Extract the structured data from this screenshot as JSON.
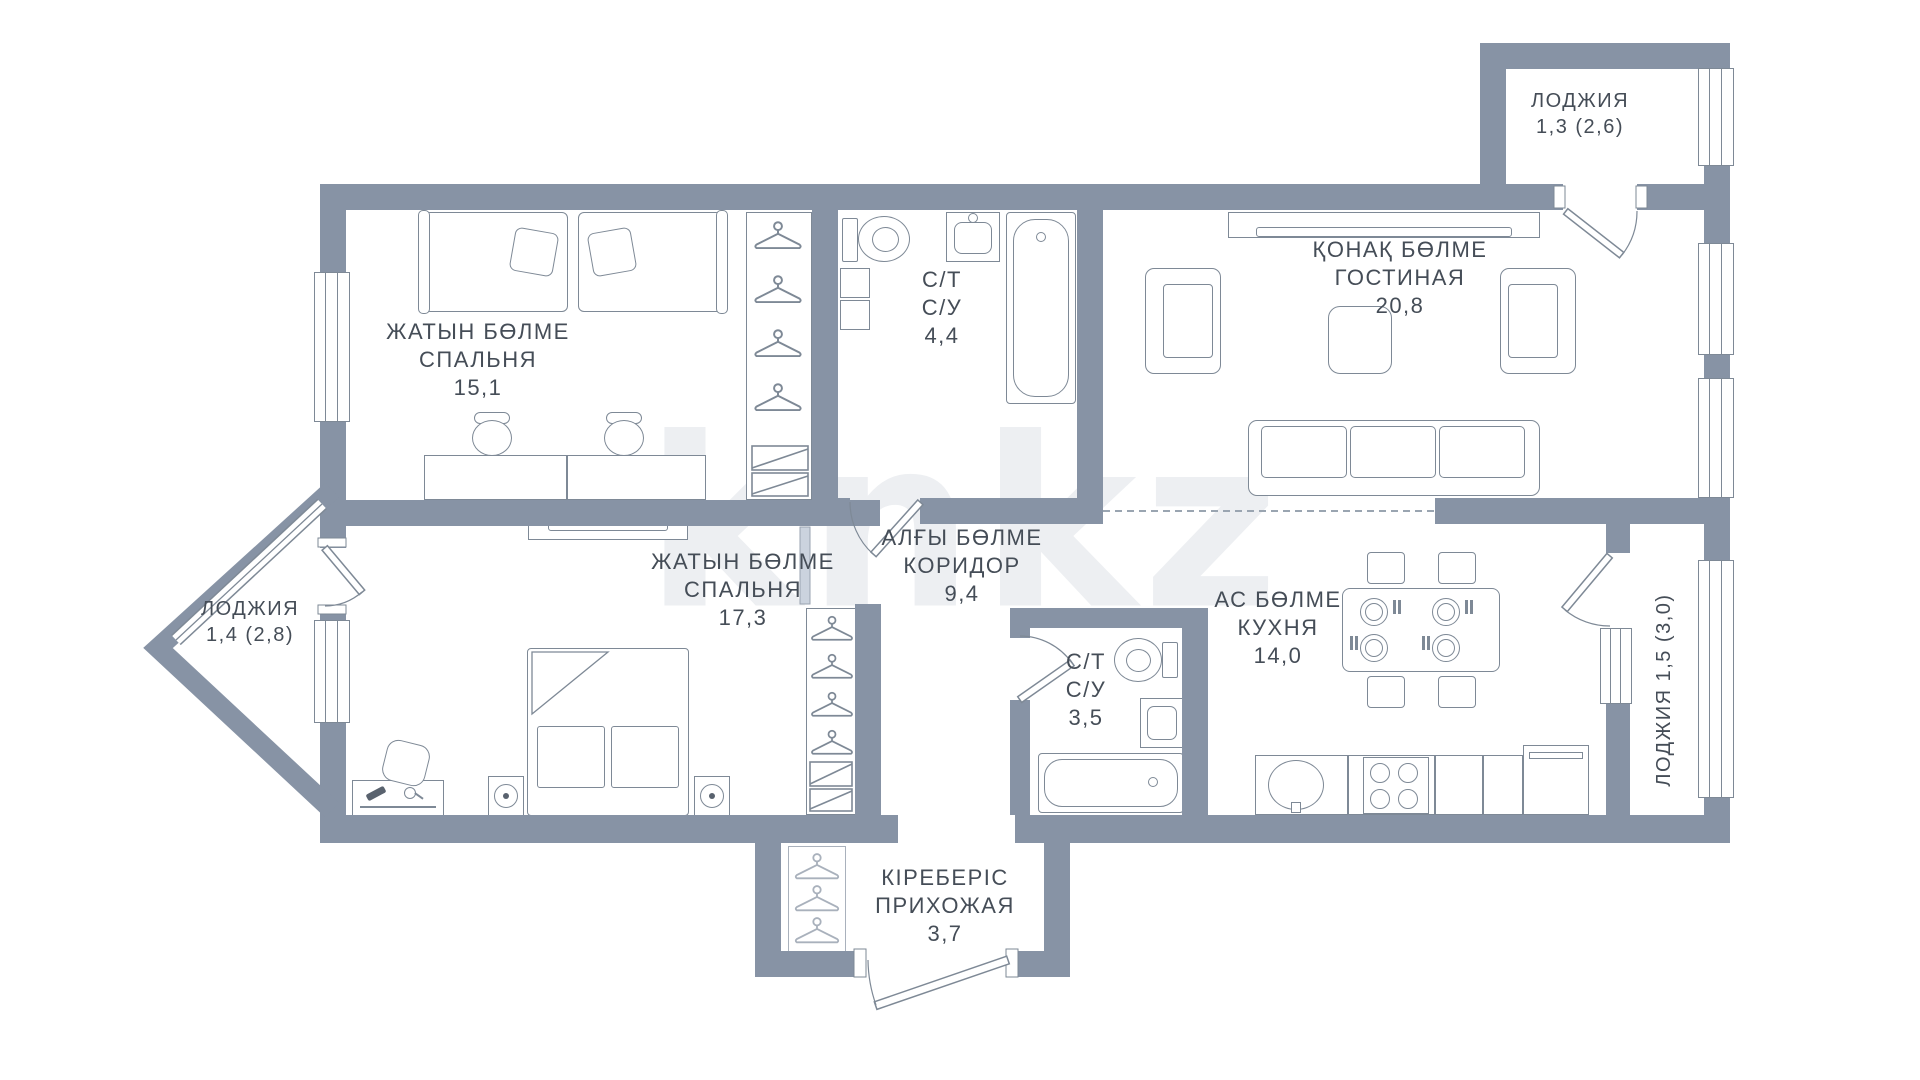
{
  "watermark": "knkz",
  "palette": {
    "wall": "#8793A5",
    "furniture_line": "#7E8996",
    "light_line": "#A9B1BC",
    "text": "#454D57",
    "watermark": "#EDEFF2",
    "zone_dash": "#9AA5B1"
  },
  "rooms": {
    "bedroom1": {
      "kk": "ЖАТЫН БӨЛМЕ",
      "ru": "СПАЛЬНЯ",
      "area": "15,1"
    },
    "bedroom2": {
      "kk": "ЖАТЫН БӨЛМЕ",
      "ru": "СПАЛЬНЯ",
      "area": "17,3"
    },
    "living": {
      "kk": "ҚОНАҚ БӨЛМЕ",
      "ru": "ГОСТИНАЯ",
      "area": "20,8"
    },
    "kitchen": {
      "kk": "АС БӨЛМЕ",
      "ru": "КУХНЯ",
      "area": "14,0"
    },
    "corridor": {
      "kk": "АЛҒЫ БӨЛМЕ",
      "ru": "КОРИДОР",
      "area": "9,4"
    },
    "entry": {
      "kk": "КІРЕБЕРІС",
      "ru": "ПРИХОЖАЯ",
      "area": "3,7"
    },
    "bath1": {
      "kk": "С/Т",
      "ru": "С/У",
      "area": "4,4"
    },
    "bath2": {
      "kk": "С/Т",
      "ru": "С/У",
      "area": "3,5"
    },
    "loggia_top": {
      "name": "ЛОДЖИЯ",
      "area": "1,3 (2,6)"
    },
    "loggia_left": {
      "name": "ЛОДЖИЯ",
      "area": "1,4 (2,8)"
    },
    "loggia_right": {
      "label": "ЛОДЖИЯ 1,5 (3,0)"
    }
  }
}
